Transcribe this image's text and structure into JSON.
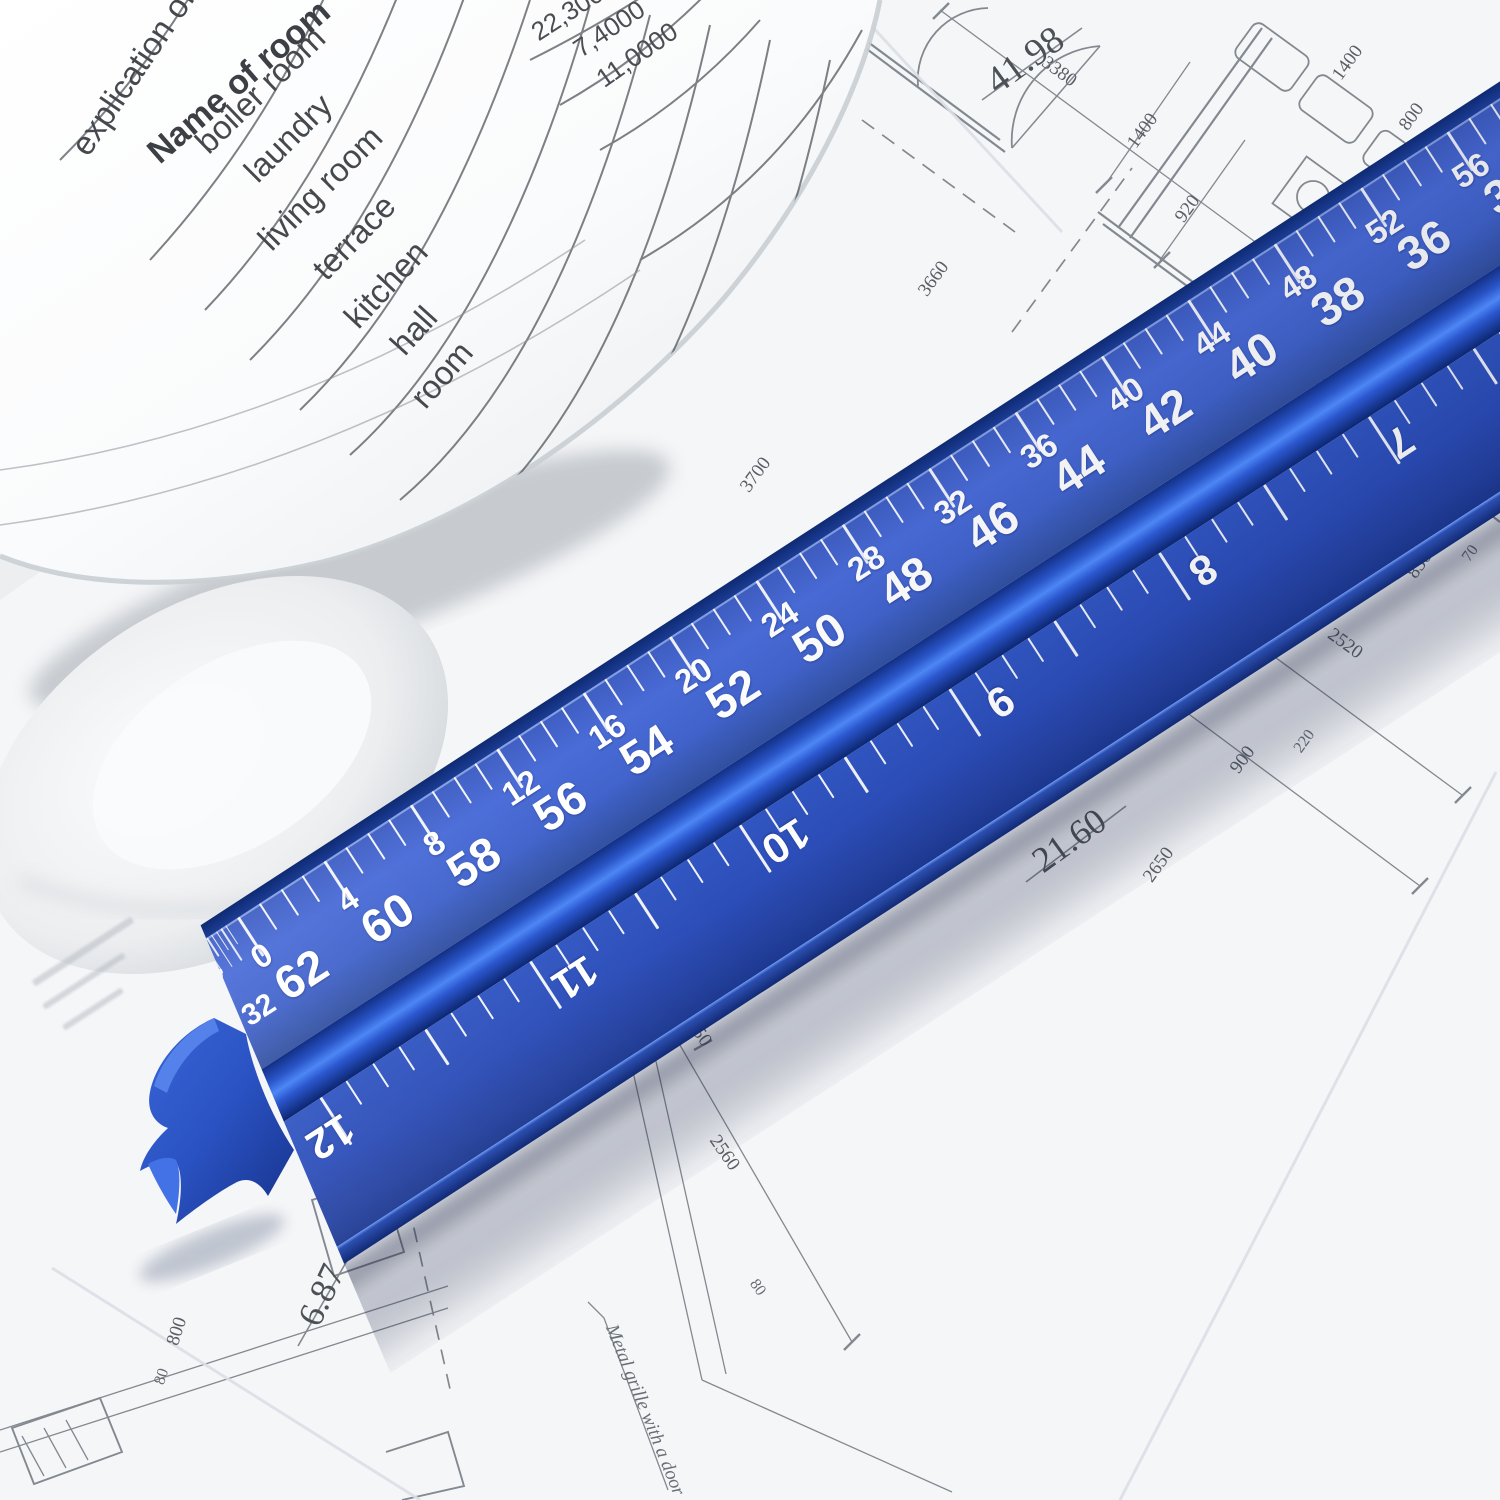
{
  "ruler": {
    "scale_label": {
      "numerator": "3",
      "denominator": "32"
    },
    "upper_scale_increasing": [
      "0",
      "4",
      "8",
      "12",
      "16",
      "20",
      "24",
      "28",
      "32",
      "36",
      "40",
      "44",
      "48",
      "52",
      "56",
      "60",
      "64"
    ],
    "upper_scale_decreasing": [
      "62",
      "60",
      "58",
      "56",
      "54",
      "52",
      "50",
      "48",
      "46",
      "44",
      "42",
      "40",
      "38",
      "36",
      "34",
      "32"
    ],
    "lower_scale_inches": [
      "12",
      "11",
      "10",
      "9",
      "8",
      "7"
    ],
    "colors": {
      "face_upper": "#4465cd",
      "face_lower": "#2c4db8",
      "ridge_highlight": "#4d86f5",
      "edge_dark": "#14307c",
      "tick_color": "#ffffff"
    }
  },
  "rolled_document": {
    "title_fragment": "explication of",
    "column_header": "Name of room",
    "room_rows": [
      "boiler room",
      "laundry",
      "living room",
      "terrace",
      "kitchen",
      "hall",
      "room"
    ],
    "area_values": [
      "22,3000",
      "7,4000",
      "11,0000"
    ]
  },
  "blueprint": {
    "note": "Metal grille with a door",
    "dims_large": {
      "top": "41.98",
      "mid": "65.49",
      "right_upper": "21.20",
      "right_lower": "21.60",
      "bottom_center": "5.22",
      "bottom_left": "6.87"
    },
    "dims_small": {
      "a": "3380",
      "b": "920",
      "c": "1400",
      "d": "1400",
      "e": "800",
      "f": "370",
      "g": "3660",
      "h": "3700",
      "i": "1200",
      "j": "2520",
      "k": "830",
      "l": "70",
      "m": "900",
      "n": "220",
      "o": "2650",
      "p": "1050",
      "q": "2560",
      "r": "80",
      "s": "800",
      "t": "80"
    }
  }
}
